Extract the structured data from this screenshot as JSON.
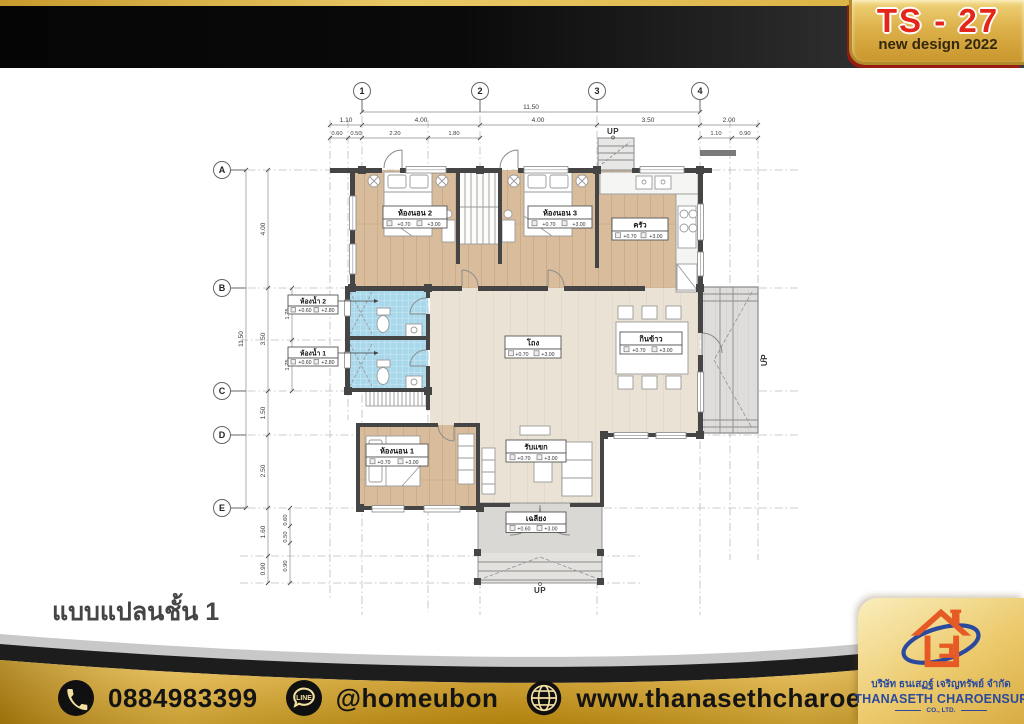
{
  "header": {
    "badge_title": "TS - 27",
    "badge_subtitle": "new design 2022"
  },
  "caption": "แบบแปลนชั้น 1",
  "footer": {
    "phone": "0884983399",
    "line_id": "@homeubon",
    "website": "www.thanasethcharoehsup.co.th",
    "line_icon_text": "LINE"
  },
  "company": {
    "name_th": "บริษัท ธนเสฏฐ์ เจริญทรัพย์ จำกัด",
    "name_en": "THANASETH CHAROENSUP",
    "suffix": "CO., LTD."
  },
  "plan": {
    "up_label": "UP",
    "grid_cols": [
      "1",
      "2",
      "3",
      "4"
    ],
    "grid_rows": [
      "A",
      "B",
      "C",
      "D",
      "E"
    ],
    "dims": {
      "top_overall": "11.50",
      "top_main": [
        "1.10",
        "4.00",
        "4.00",
        "3.50",
        "2.00"
      ],
      "top_sub": [
        "0.60",
        "0.50",
        "2.20",
        "1.80",
        "1.10",
        "0.90"
      ],
      "left_overall": "11.50",
      "left_main": [
        "4.00",
        "3.50",
        "1.50",
        "2.50"
      ],
      "left_sub": [
        "1.75",
        "1.75"
      ],
      "left_bottom": [
        "1.60",
        "0.90"
      ],
      "left_bottom_sub": [
        "0.60",
        "0.50",
        "0.90"
      ]
    },
    "rooms": [
      {
        "name": "ห้องนอน 2",
        "floor": "+0.70",
        "ceiling": "+3.00"
      },
      {
        "name": "ห้องนอน 3",
        "floor": "+0.70",
        "ceiling": "+3.00"
      },
      {
        "name": "ครัว",
        "floor": "+0.70",
        "ceiling": "+3.00"
      },
      {
        "name": "ห้องน้ำ 2",
        "floor": "+0.60",
        "ceiling": "+2.80"
      },
      {
        "name": "ห้องน้ำ 1",
        "floor": "+0.60",
        "ceiling": "+2.80"
      },
      {
        "name": "โถง",
        "floor": "+0.70",
        "ceiling": "+3.00"
      },
      {
        "name": "กินข้าว",
        "floor": "+0.70",
        "ceiling": "+3.00"
      },
      {
        "name": "รับแขก",
        "floor": "+0.70",
        "ceiling": "+3.00"
      },
      {
        "name": "ห้องนอน 1",
        "floor": "+0.70",
        "ceiling": "+3.00"
      },
      {
        "name": "เฉลียง",
        "floor": "+0.60",
        "ceiling": "+3.00"
      }
    ]
  },
  "colors": {
    "gold": "#d9ab3c",
    "badge_red": "#e3261a",
    "brand_blue": "#2b4a9e",
    "logo_orange": "#e65a25",
    "wood_floor": "#d8bc9b",
    "tile_blue": "#a9d8ea"
  }
}
